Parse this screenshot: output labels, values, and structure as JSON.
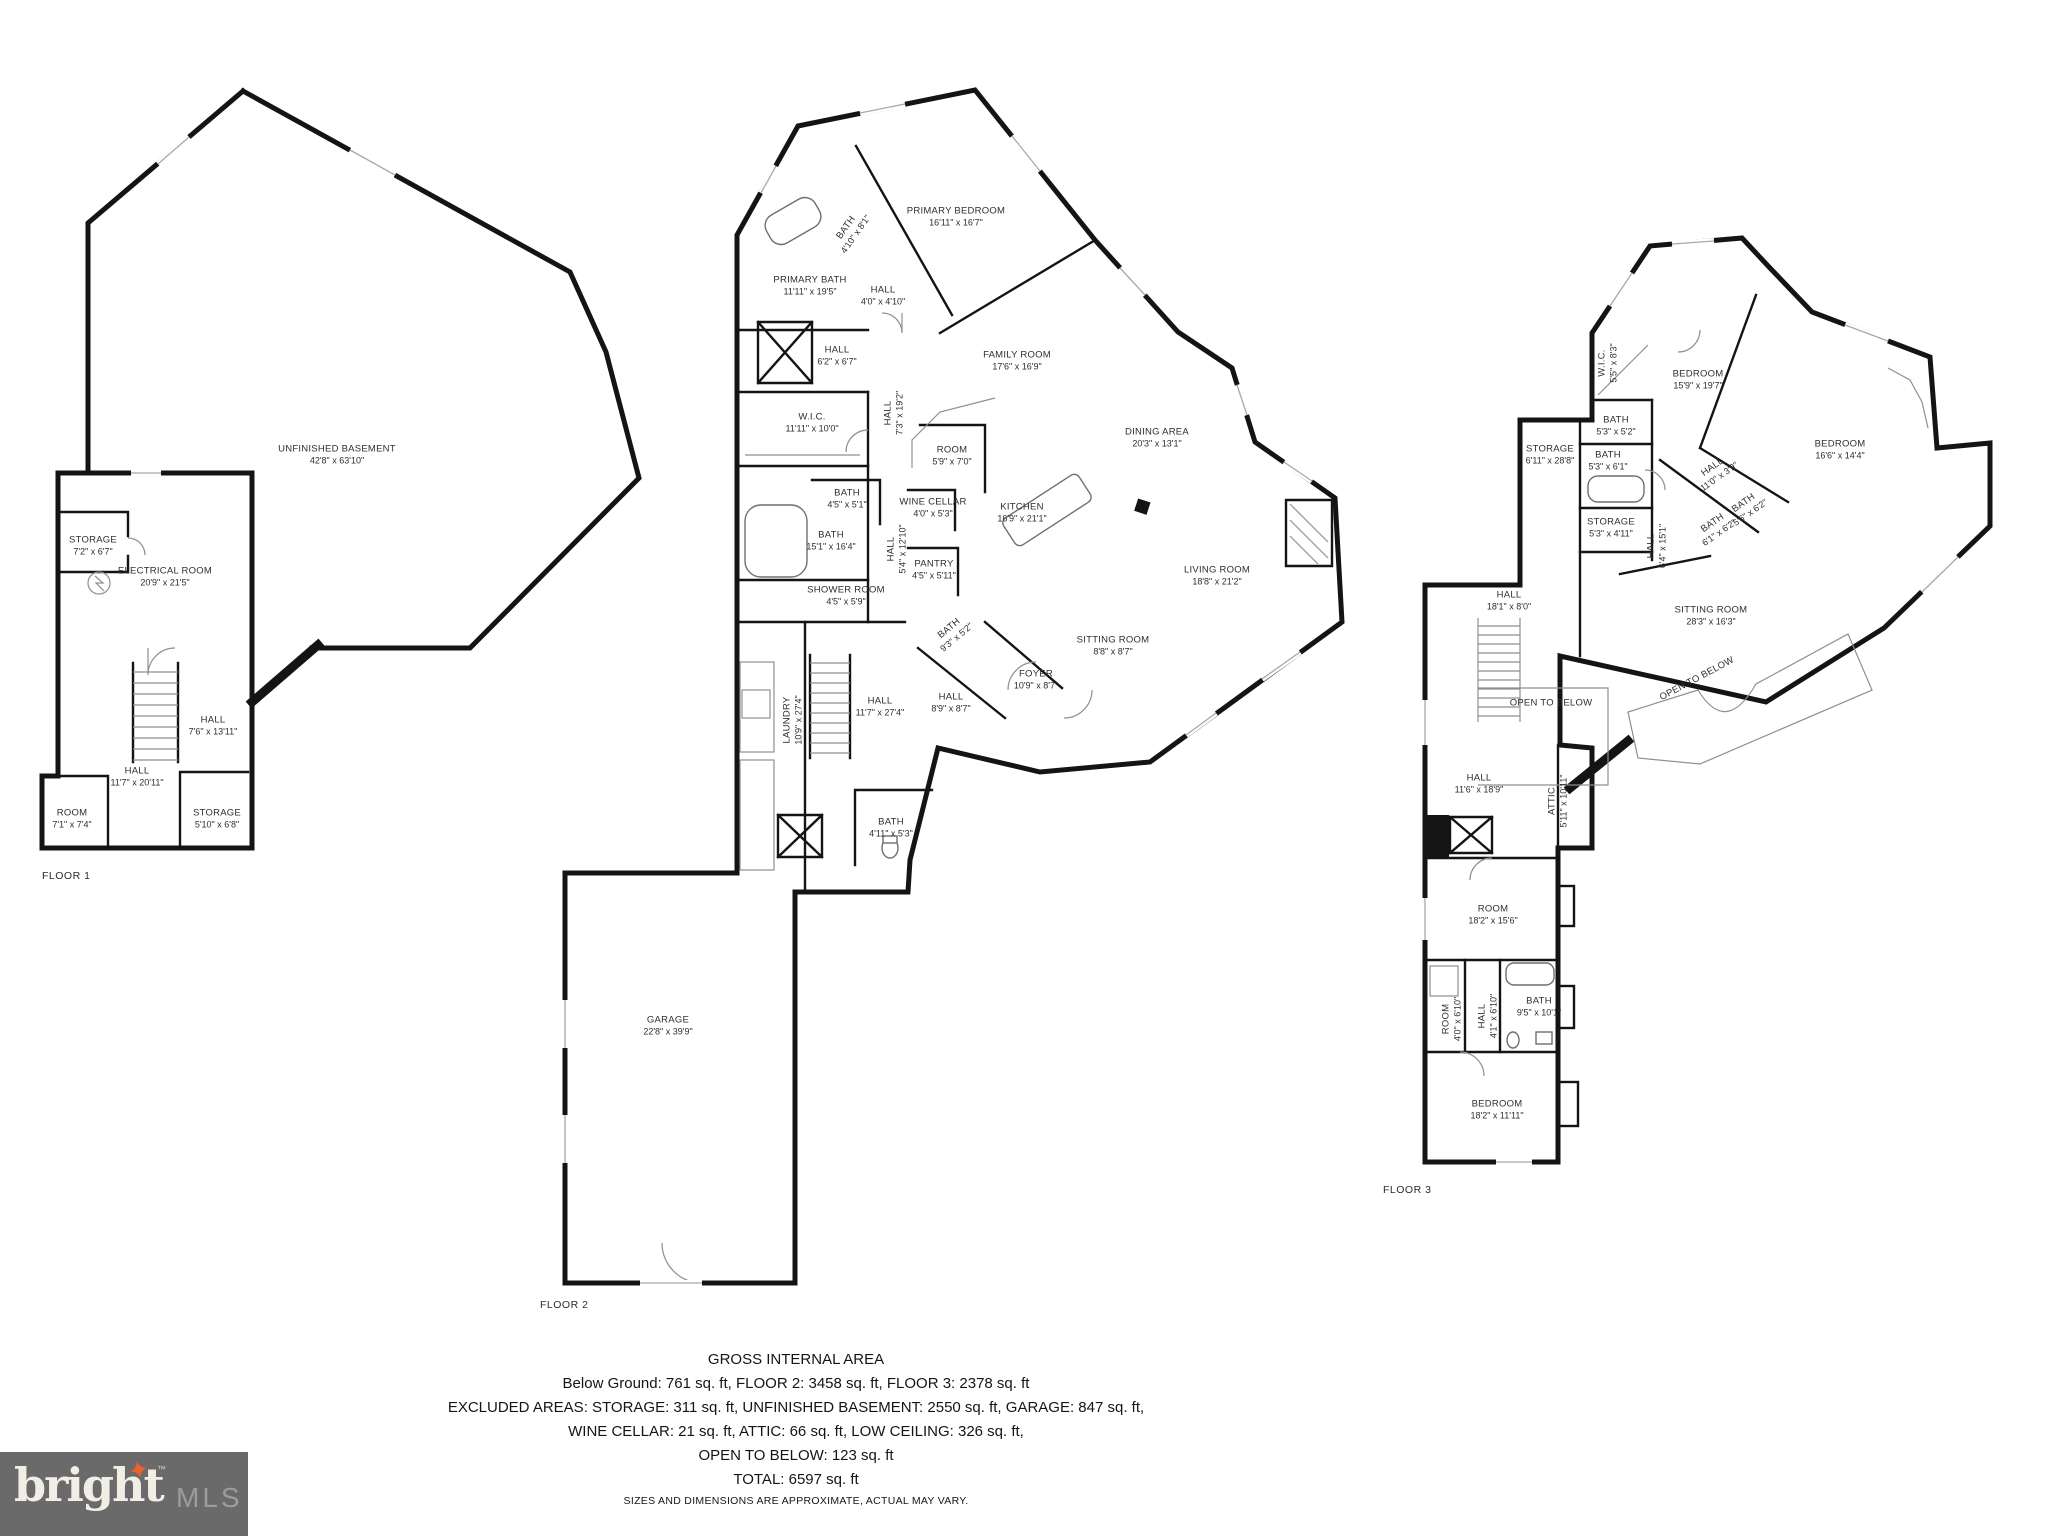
{
  "footer": {
    "title": "GROSS INTERNAL AREA",
    "line1": "Below Ground: 761 sq. ft, FLOOR 2: 3458 sq. ft, FLOOR 3: 2378 sq. ft",
    "line2": "EXCLUDED AREAS: STORAGE: 311 sq. ft, UNFINISHED BASEMENT: 2550 sq. ft, GARAGE: 847 sq. ft,",
    "line3": "WINE CELLAR: 21 sq. ft, ATTIC: 66 sq. ft, LOW CEILING: 326 sq. ft,",
    "line4": "OPEN TO BELOW: 123 sq. ft",
    "line5": "TOTAL: 6597 sq. ft",
    "disclaimer": "SIZES AND DIMENSIONS ARE APPROXIMATE, ACTUAL MAY VARY."
  },
  "logo": {
    "brand": "bright",
    "tm": "™",
    "suffix": "MLS",
    "star_color": "#e8622d",
    "background": "#6a6a6a"
  },
  "floors": [
    {
      "label": "FLOOR 1",
      "label_x": 42,
      "label_y": 870,
      "rooms": [
        {
          "name": "UNFINISHED BASEMENT",
          "dims": "42'8\" x 63'10\"",
          "x": 337,
          "y": 455
        },
        {
          "name": "STORAGE",
          "dims": "7'2\" x 6'7\"",
          "x": 93,
          "y": 546
        },
        {
          "name": "ELECTRICAL ROOM",
          "dims": "20'9\" x 21'5\"",
          "x": 165,
          "y": 577
        },
        {
          "name": "HALL",
          "dims": "7'6\" x 13'11\"",
          "x": 213,
          "y": 726
        },
        {
          "name": "HALL",
          "dims": "11'7\" x 20'11\"",
          "x": 137,
          "y": 777
        },
        {
          "name": "ROOM",
          "dims": "7'1\" x 7'4\"",
          "x": 72,
          "y": 819
        },
        {
          "name": "STORAGE",
          "dims": "5'10\" x 6'8\"",
          "x": 217,
          "y": 819
        }
      ]
    },
    {
      "label": "FLOOR 2",
      "label_x": 540,
      "label_y": 1299,
      "rooms": [
        {
          "name": "PRIMARY BEDROOM",
          "dims": "16'11\" x 16'7\"",
          "x": 956,
          "y": 217
        },
        {
          "name": "BATH",
          "dims": "4'10\" x 8'1\"",
          "x": 851,
          "y": 231,
          "rot": -55
        },
        {
          "name": "PRIMARY BATH",
          "dims": "11'11\" x 19'5\"",
          "x": 810,
          "y": 286
        },
        {
          "name": "HALL",
          "dims": "4'0\" x 4'10\"",
          "x": 883,
          "y": 296
        },
        {
          "name": "HALL",
          "dims": "6'2\" x 6'7\"",
          "x": 837,
          "y": 356
        },
        {
          "name": "FAMILY ROOM",
          "dims": "17'6\" x 16'9\"",
          "x": 1017,
          "y": 361
        },
        {
          "name": "W.I.C.",
          "dims": "11'11\" x 10'0\"",
          "x": 812,
          "y": 423
        },
        {
          "name": "HALL",
          "dims": "7'3\" x 19'2\"",
          "x": 894,
          "y": 413,
          "rot": -90
        },
        {
          "name": "ROOM",
          "dims": "5'9\" x 7'0\"",
          "x": 952,
          "y": 456
        },
        {
          "name": "DINING AREA",
          "dims": "20'3\" x 13'1\"",
          "x": 1157,
          "y": 438
        },
        {
          "name": "BATH",
          "dims": "4'5\" x 5'1\"",
          "x": 847,
          "y": 499
        },
        {
          "name": "WINE CELLAR",
          "dims": "4'0\" x 5'3\"",
          "x": 933,
          "y": 508
        },
        {
          "name": "KITCHEN",
          "dims": "16'9\" x 21'1\"",
          "x": 1022,
          "y": 513
        },
        {
          "name": "BATH",
          "dims": "15'1\" x 16'4\"",
          "x": 831,
          "y": 541
        },
        {
          "name": "HALL",
          "dims": "5'4\" x 12'10\"",
          "x": 897,
          "y": 549,
          "rot": -90
        },
        {
          "name": "PANTRY",
          "dims": "4'5\" x 5'11\"",
          "x": 934,
          "y": 570
        },
        {
          "name": "LIVING ROOM",
          "dims": "18'8\" x 21'2\"",
          "x": 1217,
          "y": 576
        },
        {
          "name": "SHOWER ROOM",
          "dims": "4'5\" x 5'9\"",
          "x": 846,
          "y": 596
        },
        {
          "name": "BATH",
          "dims": "9'3\" x 5'2\"",
          "x": 953,
          "y": 633,
          "rot": -40
        },
        {
          "name": "SITTING ROOM",
          "dims": "8'8\" x 8'7\"",
          "x": 1113,
          "y": 646
        },
        {
          "name": "FOYER",
          "dims": "10'9\" x 8'7\"",
          "x": 1036,
          "y": 680
        },
        {
          "name": "LAUNDRY",
          "dims": "10'9\" x 27'4\"",
          "x": 793,
          "y": 720,
          "rot": -90
        },
        {
          "name": "HALL",
          "dims": "11'7\" x 27'4\"",
          "x": 880,
          "y": 707
        },
        {
          "name": "HALL",
          "dims": "8'9\" x 8'7\"",
          "x": 951,
          "y": 703
        },
        {
          "name": "BATH",
          "dims": "4'11\" x 5'3\"",
          "x": 891,
          "y": 828
        },
        {
          "name": "GARAGE",
          "dims": "22'8\" x 39'9\"",
          "x": 668,
          "y": 1026
        }
      ]
    },
    {
      "label": "FLOOR 3",
      "label_x": 1383,
      "label_y": 1184,
      "rooms": [
        {
          "name": "W.I.C.",
          "dims": "5'5\" x 8'3\"",
          "x": 1608,
          "y": 363,
          "rot": -90
        },
        {
          "name": "BEDROOM",
          "dims": "15'9\" x 19'7\"",
          "x": 1698,
          "y": 380
        },
        {
          "name": "BEDROOM",
          "dims": "16'6\" x 14'4\"",
          "x": 1840,
          "y": 450
        },
        {
          "name": "STORAGE",
          "dims": "6'11\" x 28'8\"",
          "x": 1550,
          "y": 455
        },
        {
          "name": "BATH",
          "dims": "5'3\" x 5'2\"",
          "x": 1616,
          "y": 426
        },
        {
          "name": "BATH",
          "dims": "5'3\" x 6'1\"",
          "x": 1608,
          "y": 461
        },
        {
          "name": "HALL",
          "dims": "11'0\" x 3'9\"",
          "x": 1716,
          "y": 472,
          "rot": -35
        },
        {
          "name": "BATH",
          "dims": "5'6\" x 6'2\"",
          "x": 1747,
          "y": 508,
          "rot": -35
        },
        {
          "name": "BATH",
          "dims": "6'1\" x 6'2\"",
          "x": 1716,
          "y": 528,
          "rot": -35
        },
        {
          "name": "STORAGE",
          "dims": "5'3\" x 4'11\"",
          "x": 1611,
          "y": 528
        },
        {
          "name": "HALL",
          "dims": "6'4\" x 15'1\"",
          "x": 1657,
          "y": 546,
          "rot": -90
        },
        {
          "name": "HALL",
          "dims": "18'1\" x 8'0\"",
          "x": 1509,
          "y": 601
        },
        {
          "name": "SITTING ROOM",
          "dims": "28'3\" x 16'3\"",
          "x": 1711,
          "y": 616
        },
        {
          "name": "OPEN TO BELOW",
          "dims": "",
          "x": 1551,
          "y": 703
        },
        {
          "name": "OPEN TO BELOW",
          "dims": "",
          "x": 1697,
          "y": 679,
          "rot": -28
        },
        {
          "name": "HALL",
          "dims": "11'6\" x 18'9\"",
          "x": 1479,
          "y": 784
        },
        {
          "name": "ATTIC",
          "dims": "5'11\" x 10'11\"",
          "x": 1558,
          "y": 801,
          "rot": -90
        },
        {
          "name": "ROOM",
          "dims": "18'2\" x 15'6\"",
          "x": 1493,
          "y": 915
        },
        {
          "name": "ROOM",
          "dims": "4'0\" x 6'10\"",
          "x": 1452,
          "y": 1019,
          "rot": -90
        },
        {
          "name": "HALL",
          "dims": "4'1\" x 6'10\"",
          "x": 1488,
          "y": 1016,
          "rot": -90
        },
        {
          "name": "BATH",
          "dims": "9'5\" x 10'1\"",
          "x": 1539,
          "y": 1007
        },
        {
          "name": "BEDROOM",
          "dims": "18'2\" x 11'11\"",
          "x": 1497,
          "y": 1110
        }
      ]
    }
  ]
}
